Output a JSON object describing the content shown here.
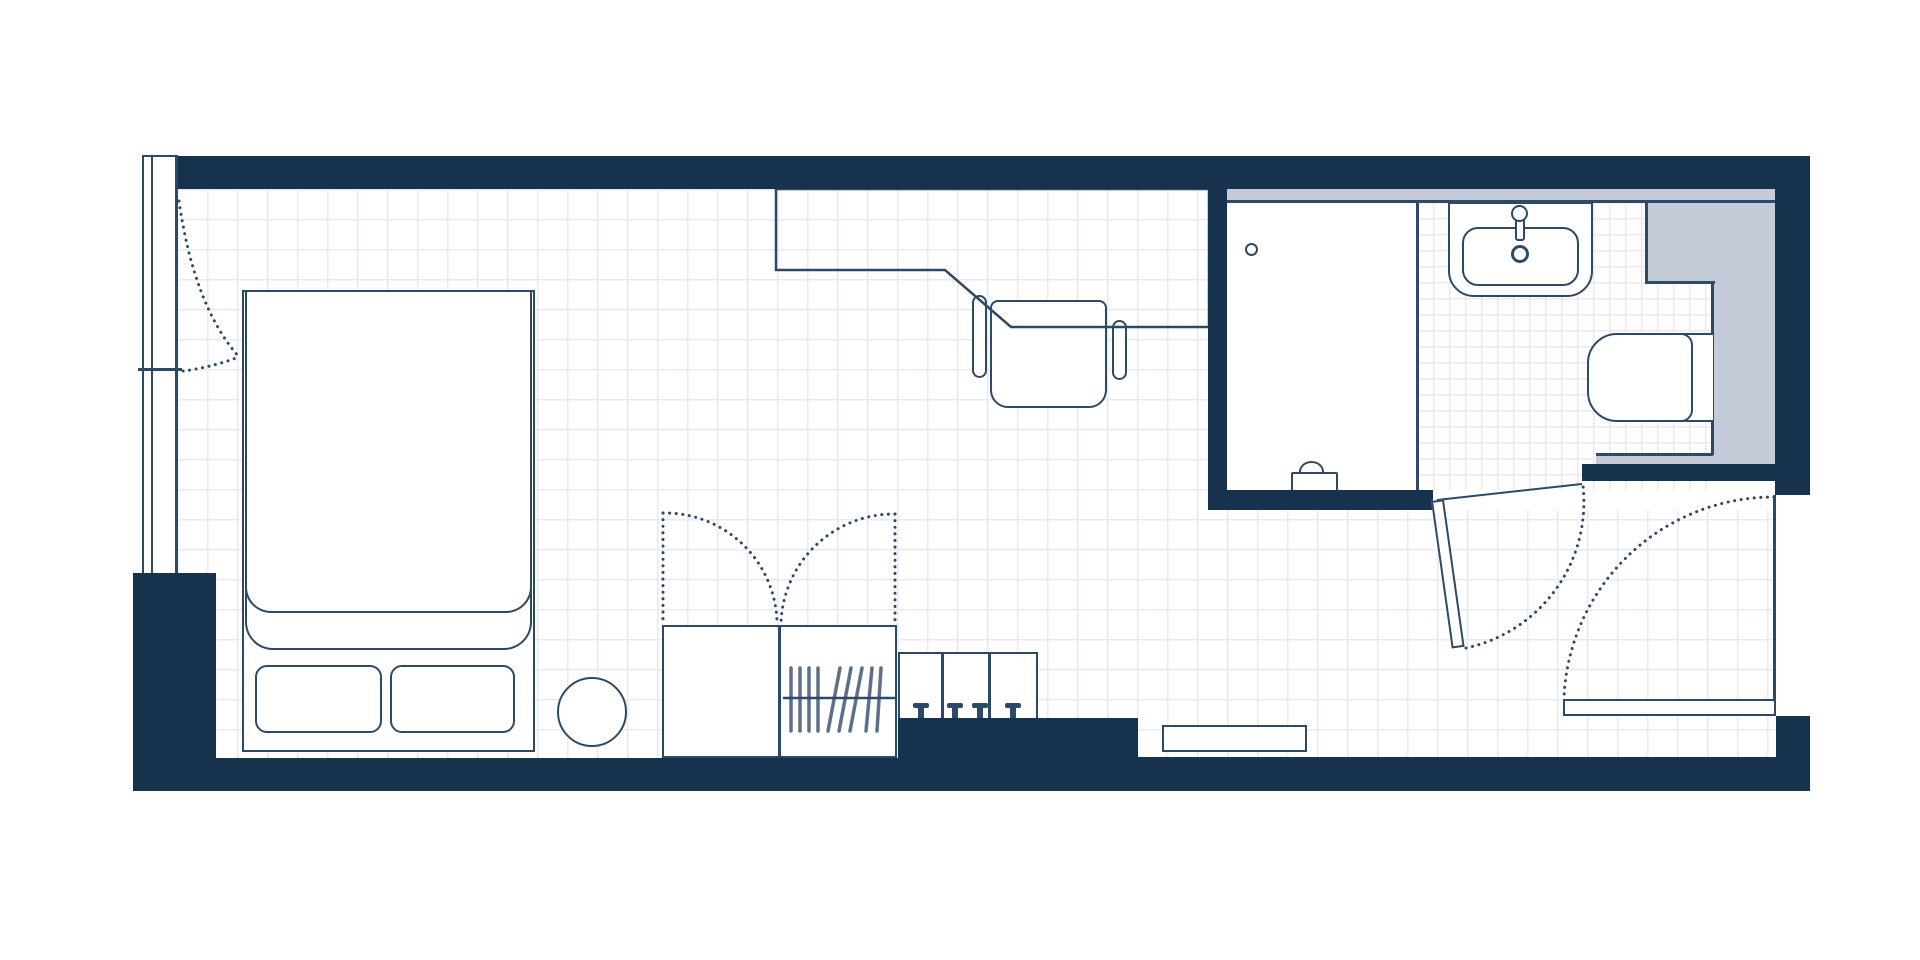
{
  "colors": {
    "wall": "#16324c",
    "outline": "#2c4a68",
    "hanger": "#5d7089",
    "tile_gray": "#c5cad8",
    "grid_main": "#e7eaf4",
    "grid_bath": "#f2e6e8",
    "floor": "#ffffff"
  },
  "plan": {
    "type": "studio-room-floor-plan",
    "rooms": [
      "bedroom-living-area",
      "bathroom",
      "entry"
    ],
    "fixtures": [
      "window-wall",
      "window-curtain-swing",
      "double-bed",
      "pillow",
      "pillow",
      "bedside-stool",
      "wardrobe-double-doors",
      "clothes-hangers",
      "drawer-unit",
      "desk",
      "desk-chair",
      "shower",
      "shower-head",
      "shower-valve",
      "washbasin",
      "faucet",
      "toilet",
      "service-wall-tiles",
      "bathroom-door",
      "entry-door",
      "door-swing-arc",
      "luggage-rack"
    ]
  }
}
